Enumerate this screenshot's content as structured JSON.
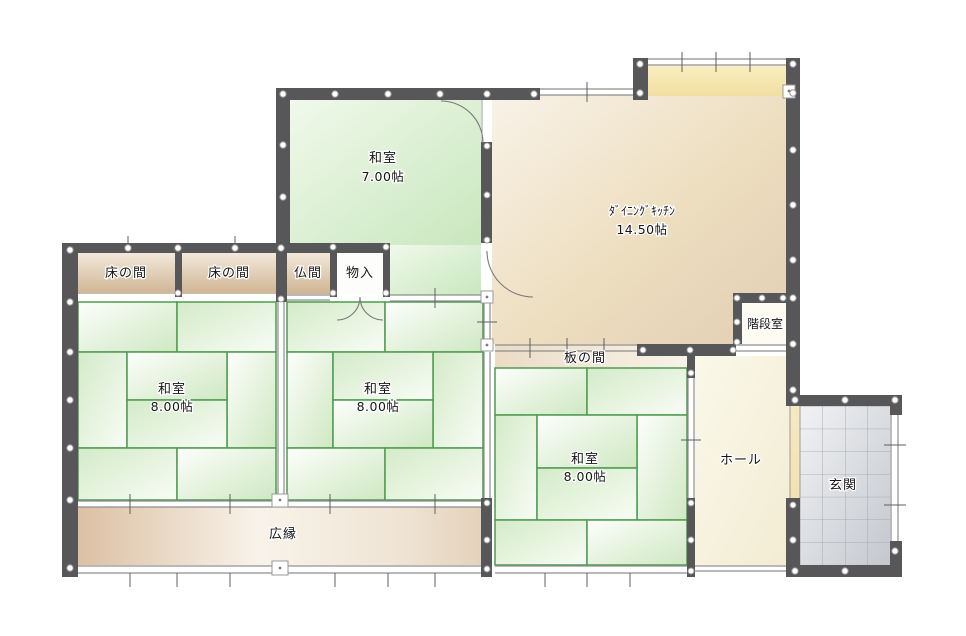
{
  "floor_plan": {
    "kind": "japanese-house-floor-plan",
    "rooms": {
      "washitsu7": {
        "name": "和室",
        "size": "7.00帖"
      },
      "dining_kitchen": {
        "name": "ﾀﾞｲﾆﾝｸﾞｷｯﾁﾝ",
        "size": "14.50帖"
      },
      "tokonoma_left": {
        "name": "床の間"
      },
      "tokonoma_right": {
        "name": "床の間"
      },
      "butsuma": {
        "name": "仏間"
      },
      "monoire": {
        "name": "物入"
      },
      "washitsu8_left": {
        "name": "和室",
        "size": "8.00帖"
      },
      "washitsu8_center": {
        "name": "和室",
        "size": "8.00帖"
      },
      "washitsu8_right": {
        "name": "和室",
        "size": "8.00帖"
      },
      "itanoma": {
        "name": "板の間"
      },
      "stairwell": {
        "name": "階段室"
      },
      "hall": {
        "name": "ホール"
      },
      "entrance": {
        "name": "玄関"
      },
      "hiroen": {
        "name": "広縁"
      }
    },
    "colors": {
      "wall": "#57575a",
      "tatami_line": "#4e9b51",
      "tatami_fill": "#d7edcb",
      "dk_fill": "#e9d8c2",
      "alcove_fill": "#d9bfa4",
      "veranda_fill": "#e3c9ad",
      "hall_fill": "#f7f3dd",
      "entrance_tile": "#cdd0d5",
      "counter_fill": "#f6e8b4",
      "step_fill": "#f4e6bb"
    }
  }
}
